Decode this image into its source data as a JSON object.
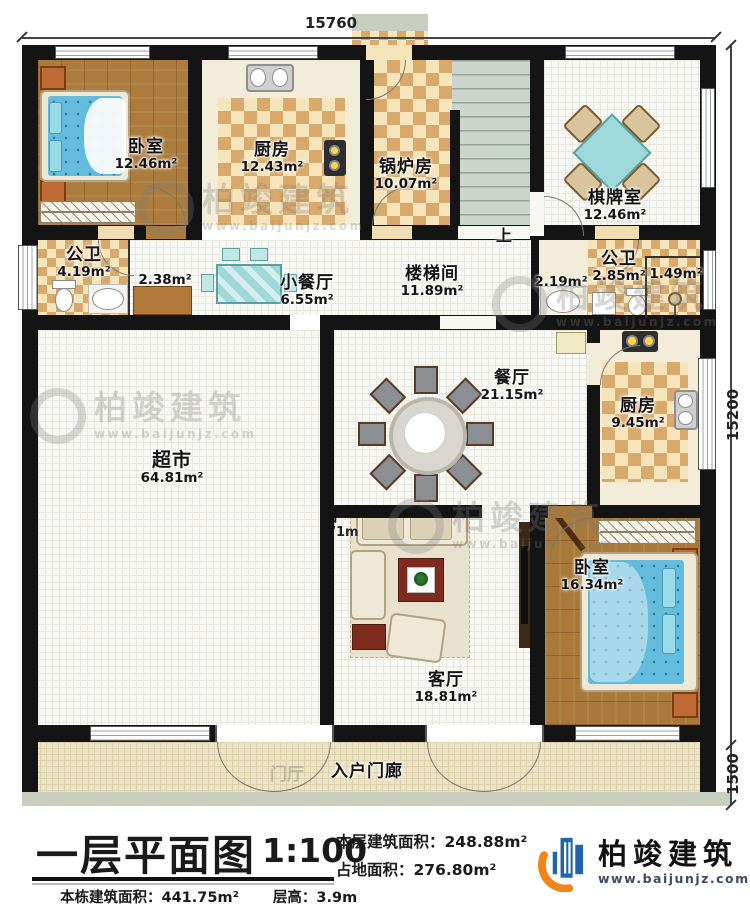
{
  "plan": {
    "dim_top": "15760",
    "dim_right": "15200",
    "dim_porch": "1500",
    "stairs_label": "上",
    "ghost_label": "门厅",
    "rooms": [
      {
        "name": "卧室",
        "area": "12.46m²"
      },
      {
        "name": "厨房",
        "area": "12.43m²"
      },
      {
        "name": "锅炉房",
        "area": "10.07m²"
      },
      {
        "name": "棋牌室",
        "area": "12.46m²"
      },
      {
        "name": "公卫",
        "area": "4.19m²"
      },
      {
        "name": "小餐厅",
        "area": "6.55m²"
      },
      {
        "name": "楼梯间",
        "area": "11.89m²"
      },
      {
        "name": "公卫",
        "area": "2.85m²"
      },
      {
        "name": "餐厅",
        "area": "21.15m²"
      },
      {
        "name": "厨房",
        "area": "9.45m²"
      },
      {
        "name": "超市",
        "area": "64.81m²"
      },
      {
        "name": "客厅",
        "area": "18.81m²"
      },
      {
        "name": "卧室",
        "area": "16.34m²"
      },
      {
        "name": "入户门廊",
        "area": ""
      }
    ],
    "small_areas": [
      "2.38m²",
      "2.19m²",
      "1.49m²"
    ],
    "occluded_label": {
      "name_visible": "台",
      "area_visible": ".71m"
    }
  },
  "watermark": {
    "brand": "柏竣建筑",
    "url": "www.baijunjz.com"
  },
  "titleblock": {
    "title": "一层平面图",
    "scale": "1:100",
    "floor_area_label": "本层建筑面积：",
    "floor_area": "248.88m²",
    "site_area_label": "占地面积：",
    "site_area": "276.80m²",
    "building_area_label": "本栋建筑面积：",
    "building_area": "441.75m²",
    "height_label": "层高：",
    "height": "3.9m",
    "logo_brand": "柏竣建筑",
    "logo_url": "www.baijunjz.com"
  }
}
